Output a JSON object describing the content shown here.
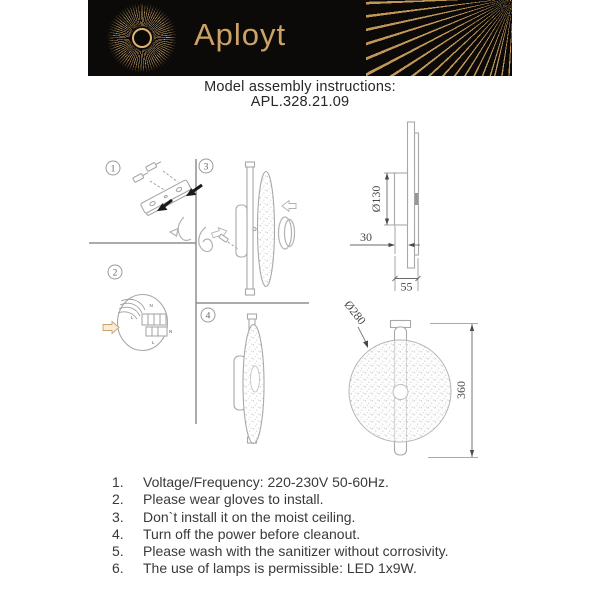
{
  "header": {
    "brand": "Aployt"
  },
  "title": {
    "line1": "Model assembly instructions:",
    "line2": "APL.328.21.09"
  },
  "steps": {
    "s1": "1",
    "s2": "2",
    "s3": "3",
    "s4": "4"
  },
  "wiring": {
    "l1": "N",
    "l2": "L",
    "l3": "N",
    "l4": "L"
  },
  "dimensions": {
    "side_diameter": "Ø130",
    "side_depth": "30",
    "side_total": "55",
    "front_diameter": "Ø280",
    "front_height": "360"
  },
  "instructions": {
    "items": [
      {
        "number": "1.",
        "text": "Voltage/Frequency: 220-230V 50-60Hz."
      },
      {
        "number": "2.",
        "text": "Please wear gloves to install."
      },
      {
        "number": "3.",
        "text": "Don`t install it on the moist ceiling."
      },
      {
        "number": "4.",
        "text": "Turn off the power before cleanout."
      },
      {
        "number": "5.",
        "text": "Please wash with the sanitizer without corrosivity."
      },
      {
        "number": "6.",
        "text": "The use of lamps is permissible: LED 1x9W."
      }
    ]
  },
  "colors": {
    "gold": "#c79e63",
    "header_bg": "#0c0a08",
    "line_gray": "#a8a8a8",
    "dim_text": "#474747",
    "body_text": "#3a3a3a"
  }
}
